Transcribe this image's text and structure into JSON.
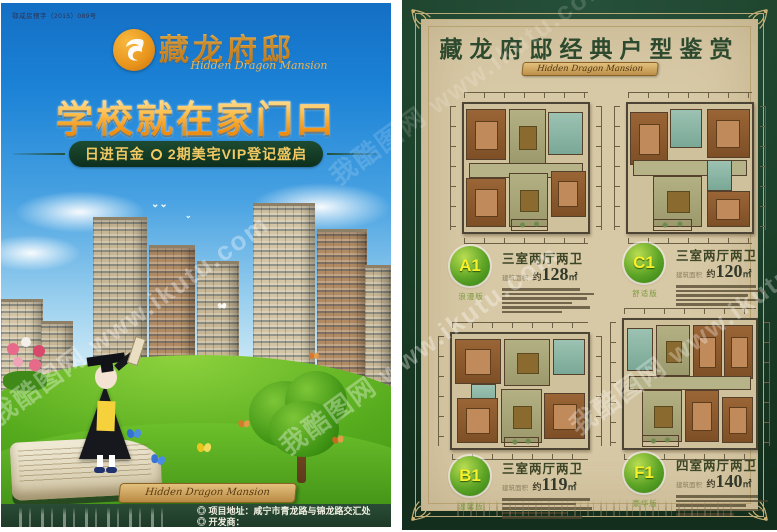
{
  "watermark": {
    "text": "我酷图网 www.ikutu.com"
  },
  "left_page": {
    "permit_number": "鄂咸房预字（2015）089号",
    "logo": {
      "brand": "藏龙府邸",
      "brand_en": "Hidden Dragon Mansion"
    },
    "headline": "学校就在家门口",
    "banner": {
      "left": "日进百金",
      "right": "2期美宅VIP登记盛启"
    },
    "ribbon_script": "Hidden Dragon Mansion",
    "footer": {
      "address_line": "◎ 项目地址：咸宁市青龙路与锦龙路交汇处",
      "developer_line": "◎ 开发商："
    }
  },
  "right_page": {
    "title": "藏龙府邸经典户型鉴赏",
    "subtitle_script": "Hidden Dragon Mansion",
    "area_label": "建筑面积",
    "approx_label": "约",
    "sqm_label": "㎡",
    "units": [
      {
        "code": "A1",
        "edition": "浪漫版",
        "layout": "三室两厅两卫",
        "area_value": "128"
      },
      {
        "code": "C1",
        "edition": "舒适版",
        "layout": "三室两厅两卫",
        "area_value": "120"
      },
      {
        "code": "B1",
        "edition": "温馨版",
        "layout": "三室两厅两卫",
        "area_value": "119"
      },
      {
        "code": "F1",
        "edition": "豪华版",
        "layout": "四室两厅两卫",
        "area_value": "140"
      }
    ]
  }
}
